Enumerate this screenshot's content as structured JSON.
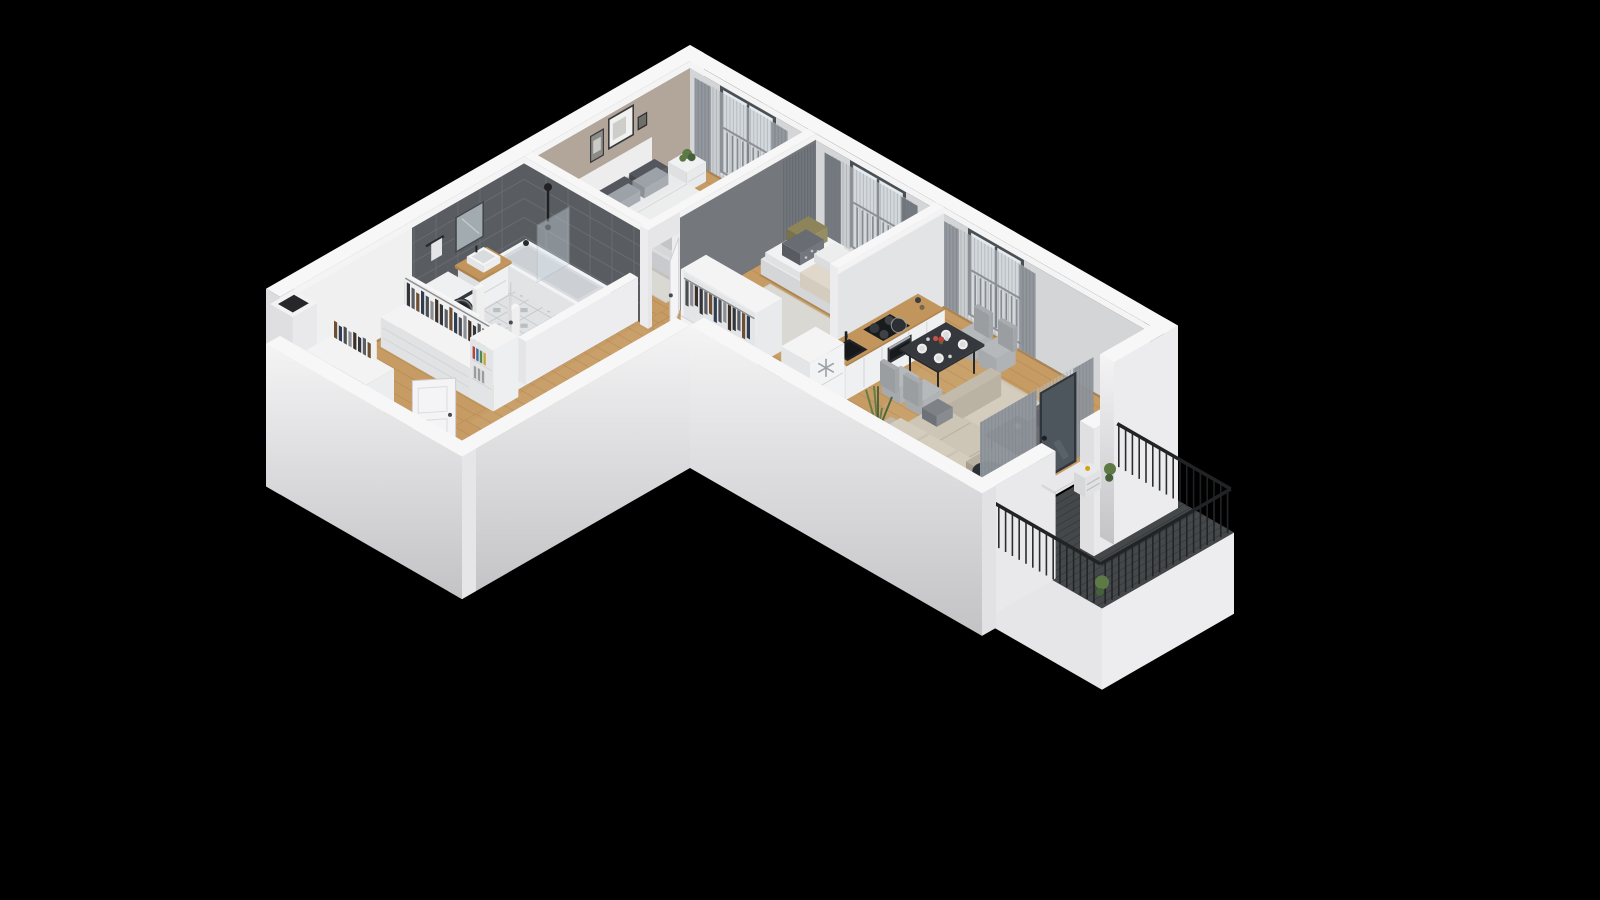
{
  "scene": {
    "type": "isometric-3d-floor-plan",
    "description": "3D cutaway isometric render of an L-shaped two-bedroom apartment with balcony on a black background",
    "view": "isometric-from-south-east",
    "background": "#000000"
  },
  "palette": {
    "bg": "#000000",
    "wallTop": "#f7f7f8",
    "wallFaceFront": "#dcdcde",
    "wallFaceSide": "#ececee",
    "innerFace": "#f0f0f1",
    "windowWallFace": "#d3d5d7",
    "topBand": "#f4f4f5",
    "beigeWall": "#b2a59a",
    "darkTileWall": "#595d61",
    "tileGrout": "#6a6e72",
    "bed2Wall": "#74787d",
    "partitionFace": "#e3e4e6",
    "outerGradTop": "#f4f4f5",
    "outerGradBottom": "#c3c3c6",
    "wood": "#c79c64",
    "woodLine": "#b08450",
    "tileFloor": "#e0e2e4",
    "tileLine": "#bcc0c5",
    "tileAccent": "#9299a0",
    "balconyFloor": "#45484b",
    "balconyLine": "#36393c",
    "railing": "#212325",
    "windowFrame": "#4a4f54",
    "windowPane": "#dde5ea",
    "windowBar": "#1f2224",
    "curtainSheer": "#c5c9cc",
    "curtainStripe": "#8a9095",
    "curtainSolid": "#8f959b",
    "curtainDark": "#70757b",
    "doorWhite": "#f4f4f6",
    "doorEdge": "#cfcfd2",
    "doorHandle": "#4b4b4e",
    "rug": "#dad8d3",
    "rugLiving": "#d5d2cb",
    "bedBase": "#dcdde0",
    "bedBaseShade": "#c9cacd",
    "linen": "#e9eaec",
    "duvetBeige": "#e0d8cb",
    "pillowDark": "#54575d",
    "pillowLight": "#9da2a8",
    "pillowOlive": "#8d8559",
    "pillowBlush": "#cdb6ae",
    "throwGray": "#c3c5c9",
    "nightstand": "#f0f1f2",
    "nightstandShade": "#dfe0e2",
    "lampDark": "#3a3b3e",
    "plantGreen": "#5d7a45",
    "plantDark": "#46603a",
    "mirror": "#a2abb0",
    "mirrorFrame": "#43474b",
    "tubWhite": "#f2f3f5",
    "tubSide": "#e1e3e5",
    "tubInner": "#ccd0d4",
    "glass": "#d8e7ee",
    "woodTop": "#c2955c",
    "woodTopShade": "#ad8450",
    "cabinet": "#eef0f1",
    "cabinetShade": "#dde0e2",
    "cabinetLine": "#d2d5d7",
    "sinkBlack": "#202326",
    "cooktop": "#191b1d",
    "burner": "#3e4246",
    "ovenDark": "#2d3034",
    "ovenHandle": "#a9adb1",
    "washerWhite": "#f1f2f3",
    "washerDoor": "#2e3236",
    "washerRing": "#8d9296",
    "fridgeWhite": "#f2f3f4",
    "snowflake": "#9aa0a5",
    "tableDark": "#35383c",
    "tableEdge": "#27292c",
    "chairGray": "#b6b9bb",
    "chairBack": "#a9acae",
    "plate": "#f0f0f0",
    "flowerRed": "#b8433a",
    "sofa": "#cdc6b6",
    "sofaShade": "#b9b2a2",
    "sofaCushion": "#d4cdbd",
    "sofaArm": "#c2bbab",
    "tvDark": "#23262a",
    "drumDark": "#26282b",
    "valveYellow": "#d3a21a",
    "glassDoorFrame": "#2f353b",
    "glassDoorPane": "#4d555d",
    "shaftSlot": "#27272a",
    "clothes": [
      "#33353a",
      "#5a5d63",
      "#6e4f33",
      "#2e3d52",
      "#4a4d52",
      "#8c8f94",
      "#3c3026"
    ],
    "books": [
      "#b8433a",
      "#3a6ea5",
      "#4f8a4f",
      "#caa53c"
    ]
  },
  "rooms": [
    {
      "id": "master-bedroom",
      "furniture": [
        "double-bed",
        "headboard",
        "pillows",
        "nightstand",
        "table-lamp",
        "potted-plant",
        "area-rug",
        "wall-art",
        "window",
        "curtains"
      ]
    },
    {
      "id": "bedroom-2",
      "furniture": [
        "single-bed",
        "desk",
        "desk-chair",
        "open-wardrobe",
        "area-rug",
        "window",
        "curtains"
      ]
    },
    {
      "id": "bathroom",
      "furniture": [
        "bathtub",
        "shower-screen",
        "shower-set",
        "vanity-sink",
        "mirror",
        "washing-machine",
        "towel-rail",
        "door"
      ]
    },
    {
      "id": "hallway",
      "furniture": [
        "open-closet",
        "shelf-unit",
        "storage-cabinets",
        "entry-door",
        "doormat"
      ]
    },
    {
      "id": "kitchen-dining",
      "furniture": [
        "kitchen-counter",
        "sink",
        "faucet",
        "cooktop",
        "oven",
        "fridge-freezer",
        "dining-table",
        "dining-chairs",
        "tableware",
        "flowers",
        "window",
        "curtains"
      ]
    },
    {
      "id": "living-room",
      "furniture": [
        "corner-sofa",
        "coffee-table",
        "side-table",
        "tv-panel",
        "media-bench",
        "floor-plant",
        "area-rug",
        "balcony-door",
        "curtains"
      ]
    },
    {
      "id": "balcony",
      "furniture": [
        "railing",
        "planter-plants",
        "heater-unit"
      ]
    }
  ],
  "structure": [
    "exterior-wall-north",
    "exterior-wall-east",
    "ventilation-shaft",
    "partition-bed1-bath",
    "partition-bed1-bed2",
    "partition-bed2-kitchen",
    "front-walls",
    "floors"
  ]
}
